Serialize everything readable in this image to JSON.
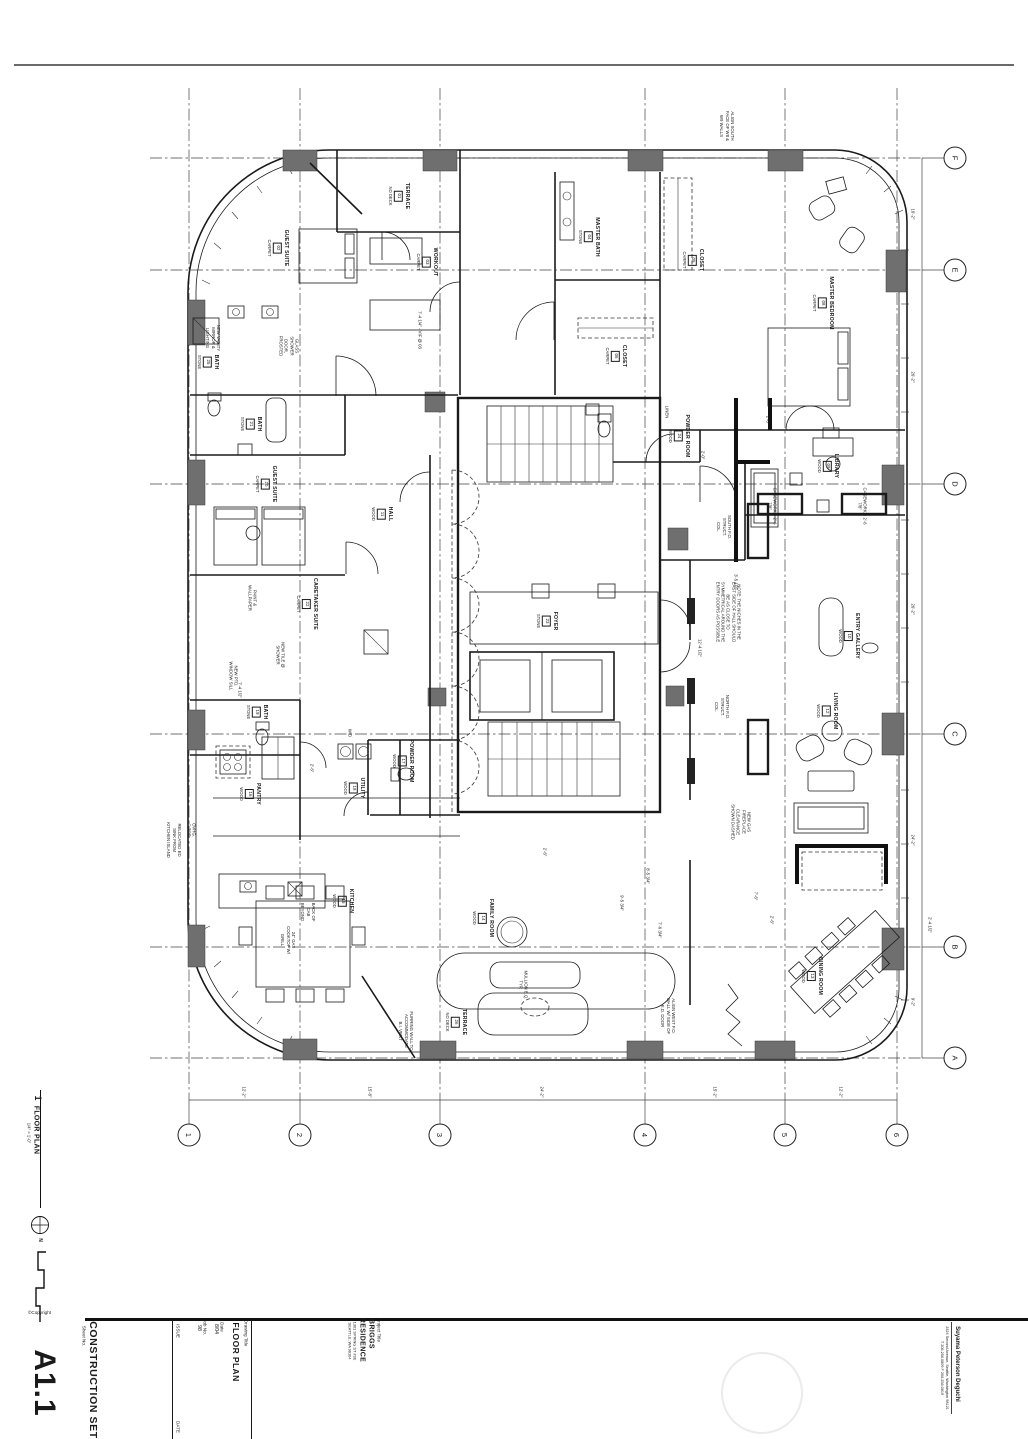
{
  "sheet": {
    "copyright": "©Copyright",
    "sheet_no_label": "Sheet No.",
    "sheet_no": "A1.1",
    "set_title": "CONSTRUCTION SET",
    "issue_label": "ISSUE",
    "date_label": "DATE",
    "drawing_title_label": "Drawing Title",
    "drawing_title": "FLOOR PLAN",
    "date_field_label": "Date",
    "date_value": "8/04",
    "job_label": "Job No.",
    "job_value": "98",
    "project_title_label": "Project Title",
    "project_name_1": "BRIGGS",
    "project_name_2": "RESIDENCE",
    "project_address_1": "1301 SPRING ST #3E",
    "project_address_2": "SEATTLE, WA 98104",
    "firm_name": "Suyama Peterson Deguchi",
    "firm_address": "2324 Second Avenue, Seattle, Washington 98121",
    "firm_phone": "T 206.256.0809   F 206.256.0819"
  },
  "plan_title": {
    "number": "1",
    "title": "FLOOR PLAN",
    "scale": "1/4\" = 1'-0\"",
    "north_label": "N"
  },
  "grid": {
    "cols": [
      {
        "label": "1",
        "x": 189
      },
      {
        "label": "2",
        "x": 300
      },
      {
        "label": "3",
        "x": 440
      },
      {
        "label": "4",
        "x": 645
      },
      {
        "label": "5",
        "x": 785
      },
      {
        "label": "6",
        "x": 897
      }
    ],
    "rows": [
      {
        "label": "F",
        "y": 158
      },
      {
        "label": "E",
        "y": 270
      },
      {
        "label": "D",
        "y": 484
      },
      {
        "label": "C",
        "y": 734
      },
      {
        "label": "B",
        "y": 947
      },
      {
        "label": "A",
        "y": 1058
      }
    ]
  },
  "rooms": [
    {
      "name": "TERRACE",
      "tag": "01",
      "finish": "NO DECK",
      "x": 399,
      "y": 196
    },
    {
      "name": "GUEST SUITE",
      "tag": "02",
      "finish": "CARPET",
      "x": 278,
      "y": 248
    },
    {
      "name": "WORKOUT",
      "tag": "03",
      "finish": "CARPET",
      "x": 427,
      "y": 262
    },
    {
      "name": "MASTER BATH",
      "tag": "04",
      "finish": "STONE",
      "x": 589,
      "y": 237
    },
    {
      "name": "CLOSET",
      "tag": "05",
      "finish": "CARPET",
      "x": 693,
      "y": 260
    },
    {
      "name": "CLOSET",
      "tag": "06",
      "finish": "CARPET",
      "x": 616,
      "y": 356
    },
    {
      "name": "MASTER BEDROOM",
      "tag": "08",
      "finish": "CARPET",
      "x": 823,
      "y": 303
    },
    {
      "name": "LIBRARY",
      "tag": "09",
      "finish": "WOOD",
      "x": 828,
      "y": 466
    },
    {
      "name": "ENTRY GALLERY",
      "tag": "10",
      "finish": "WOOD",
      "x": 849,
      "y": 636
    },
    {
      "name": "HALL",
      "tag": "11",
      "finish": "WOOD",
      "x": 382,
      "y": 514
    },
    {
      "name": "LIVING ROOM",
      "tag": "12",
      "finish": "WOOD",
      "x": 827,
      "y": 711
    },
    {
      "name": "DINING ROOM",
      "tag": "13",
      "finish": "WOOD",
      "x": 812,
      "y": 976
    },
    {
      "name": "FAMILY ROOM",
      "tag": "14",
      "finish": "WOOD",
      "x": 483,
      "y": 918
    },
    {
      "name": "KITCHEN",
      "tag": "15",
      "finish": "WOOD",
      "x": 343,
      "y": 901
    },
    {
      "name": "PANTRY",
      "tag": "16",
      "finish": "WOOD",
      "x": 250,
      "y": 794
    },
    {
      "name": "POWDER ROOM",
      "tag": "17",
      "finish": "WOOD",
      "x": 403,
      "y": 761
    },
    {
      "name": "UTILITY",
      "tag": "18",
      "finish": "WOOD",
      "x": 354,
      "y": 788
    },
    {
      "name": "BATH",
      "tag": "19",
      "finish": "STONE",
      "x": 257,
      "y": 712
    },
    {
      "name": "GUEST SUITE",
      "tag": "20",
      "finish": "CARPET",
      "x": 266,
      "y": 484
    },
    {
      "name": "BATH",
      "tag": "21",
      "finish": "STONE",
      "x": 251,
      "y": 424
    },
    {
      "name": "CARETAKER SUITE",
      "tag": "22",
      "finish": "CARPET",
      "x": 307,
      "y": 604
    },
    {
      "name": "FOYER",
      "tag": "23",
      "finish": "STONE",
      "x": 547,
      "y": 621
    },
    {
      "name": "POWDER ROOM",
      "tag": "24",
      "finish": "WOOD",
      "x": 679,
      "y": 436
    },
    {
      "name": "BATH",
      "tag": "25",
      "finish": "STONE",
      "x": 208,
      "y": 362
    },
    {
      "name": "TERRACE",
      "tag": "26",
      "finish": "NO DECK",
      "x": 456,
      "y": 1022
    }
  ],
  "notes": [
    {
      "text": "ALIGN SOUTH FACE OF W8 & W9 WALLS",
      "x": 727,
      "y": 126,
      "w": 34
    },
    {
      "text": "NEW VANITY MIRROR & LIGHTING",
      "x": 213,
      "y": 338,
      "w": 36
    },
    {
      "text": "GLASS SHOWER DOOR, FROSTED",
      "x": 289,
      "y": 346,
      "w": 34
    },
    {
      "text": "NEW TILE @ SHOWER",
      "x": 280,
      "y": 655,
      "w": 30
    },
    {
      "text": "PAINT & WALLPAPER",
      "x": 252,
      "y": 598,
      "w": 30
    },
    {
      "text": "NEW PTD. WINDOW SILL",
      "x": 233,
      "y": 676,
      "w": 30
    },
    {
      "text": "SOUTH F.O. STRUCT. COL.",
      "x": 724,
      "y": 527,
      "w": 28
    },
    {
      "text": "NORTH F.O. STRUCT. COL.",
      "x": 722,
      "y": 707,
      "w": 28
    },
    {
      "text": "CASEWORK = 2'-6 7/8\"",
      "x": 772,
      "y": 506,
      "w": 44
    },
    {
      "text": "CASEWORK = 2'-6 7/8\"",
      "x": 862,
      "y": 506,
      "w": 44
    },
    {
      "text": "NOTE: THE NICHES IN THE EAST SIDE OF HALL SHOULD BE AS CLOSE TO SYMMETRICAL AROUND THE ENTRY DOORS AS POSSIBLE",
      "x": 728,
      "y": 612,
      "w": 66
    },
    {
      "text": "NEW GAS FIREPLACE CLEARANCE SHOWN DASHED",
      "x": 741,
      "y": 822,
      "w": 40
    },
    {
      "text": "FURRING WALL TO ACCOMMODATE B.I. VENT",
      "x": 406,
      "y": 1031,
      "w": 40
    },
    {
      "text": "ALIGN WEST F.O. WALL W/ SIDE OF E.D. DOOR",
      "x": 668,
      "y": 1016,
      "w": 40
    },
    {
      "text": "RELOCATED ED SINK FROM KITCHEN ISLAND",
      "x": 174,
      "y": 840,
      "w": 36
    },
    {
      "text": "BACK OF CAB BEYOND",
      "x": 308,
      "y": 912,
      "w": 26
    },
    {
      "text": "24\" GAS COOKTOP W/ GRILL",
      "x": 288,
      "y": 940,
      "w": 30
    },
    {
      "text": "MULLION E.Q. TYP.",
      "x": 523,
      "y": 985,
      "w": 30
    },
    {
      "text": "OVHG. C-TOP",
      "x": 191,
      "y": 830,
      "w": 18
    },
    {
      "text": "LINEN",
      "x": 667,
      "y": 412,
      "w": 16
    },
    {
      "text": "W/D",
      "x": 350,
      "y": 733,
      "w": 14
    }
  ],
  "dims": [
    {
      "text": "12'-2\"",
      "x": 244,
      "y": 1092
    },
    {
      "text": "15'-8\"",
      "x": 370,
      "y": 1092
    },
    {
      "text": "24'-2\"",
      "x": 542,
      "y": 1092
    },
    {
      "text": "15'-2\"",
      "x": 715,
      "y": 1092
    },
    {
      "text": "12'-2\"",
      "x": 841,
      "y": 1092
    },
    {
      "text": "16'-2\"",
      "x": 913,
      "y": 214
    },
    {
      "text": "26'-2\"",
      "x": 913,
      "y": 377
    },
    {
      "text": "26'-2\"",
      "x": 913,
      "y": 609
    },
    {
      "text": "24'-2\"",
      "x": 913,
      "y": 840
    },
    {
      "text": "9'-2\"",
      "x": 913,
      "y": 1002
    },
    {
      "text": "2'-6\"",
      "x": 768,
      "y": 420
    },
    {
      "text": "2'-0\"",
      "x": 703,
      "y": 455
    },
    {
      "text": "7'-4 1/2\"",
      "x": 240,
      "y": 690
    },
    {
      "text": "2'-6\"",
      "x": 312,
      "y": 768
    },
    {
      "text": "9'-5 3/4\"",
      "x": 622,
      "y": 903
    },
    {
      "text": "8'-5 3/4\"",
      "x": 648,
      "y": 876
    },
    {
      "text": "7'-6 3/4\"",
      "x": 660,
      "y": 930
    },
    {
      "text": "7'-6\"",
      "x": 756,
      "y": 896
    },
    {
      "text": "2'-6\"",
      "x": 772,
      "y": 920
    },
    {
      "text": "2'-4 1/2\"",
      "x": 930,
      "y": 925
    },
    {
      "text": "12'-4 1/2\"",
      "x": 700,
      "y": 648
    },
    {
      "text": "3'-5 1/2\"",
      "x": 736,
      "y": 582
    },
    {
      "text": "7'-4 1/4\" - VIF @ 03",
      "x": 420,
      "y": 330
    },
    {
      "text": "2'-6\"",
      "x": 545,
      "y": 852
    }
  ]
}
